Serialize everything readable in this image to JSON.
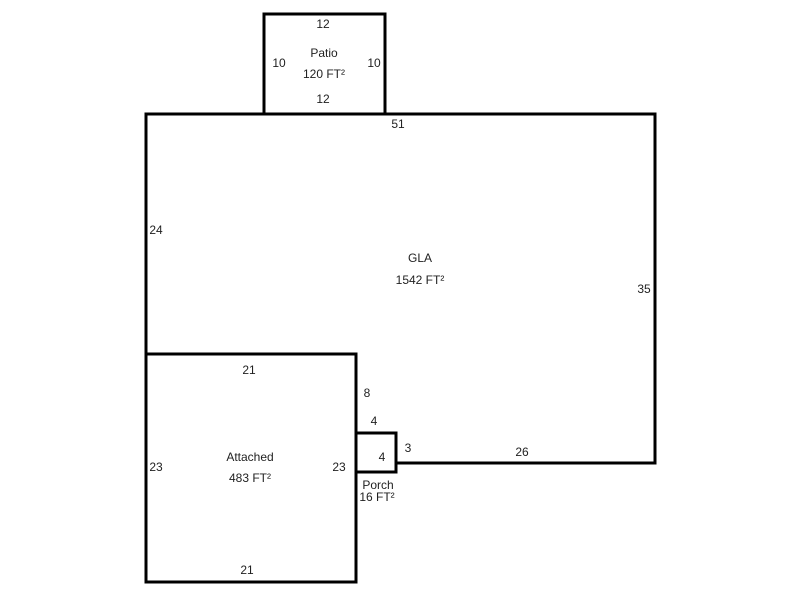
{
  "colors": {
    "background": "#ffffff",
    "line": "#000000",
    "text": "#1f1f1f"
  },
  "drawing": {
    "patio": {
      "label": "Patio",
      "area": "120 FT²",
      "dim_top": "12",
      "dim_bottom": "12",
      "dim_left": "10",
      "dim_right": "10"
    },
    "gla": {
      "label": "GLA",
      "area": "1542 FT²",
      "dim_top": "51",
      "dim_left": "24",
      "dim_right": "35",
      "dim_bottom_right": "26",
      "dim_step_vertical": "8",
      "dim_step_top": "4",
      "dim_step_right": "3"
    },
    "attached": {
      "label": "Attached",
      "area": "483 FT²",
      "dim_top": "21",
      "dim_bottom": "21",
      "dim_left": "23",
      "dim_right": "23"
    },
    "porch": {
      "label": "Porch",
      "area": "16 FT²",
      "dim_inner": "4"
    }
  }
}
